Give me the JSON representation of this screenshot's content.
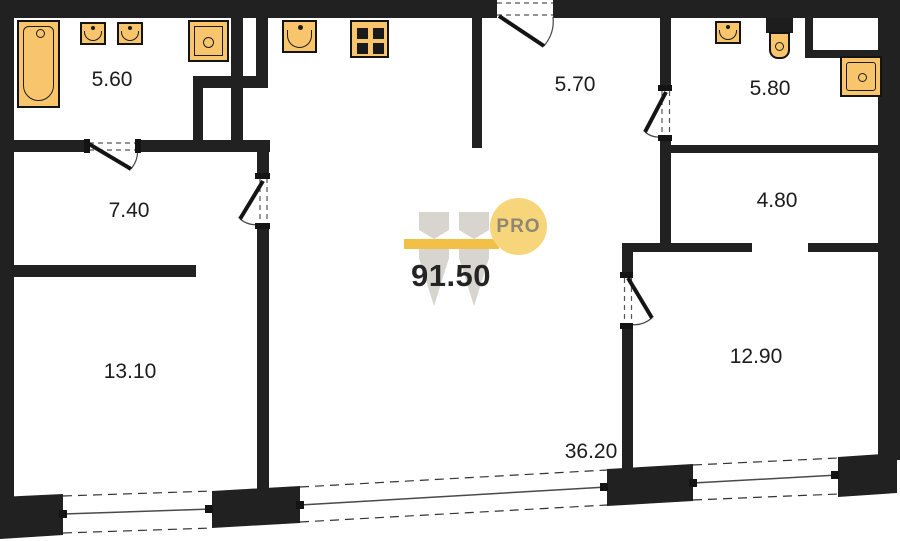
{
  "floorplan": {
    "total_area": "91.50",
    "logo": {
      "brand": "PRO"
    },
    "rooms": [
      {
        "name": "bathroom-top-left",
        "area": "5.60"
      },
      {
        "name": "corridor-left",
        "area": "7.40"
      },
      {
        "name": "bedroom-left",
        "area": "13.10"
      },
      {
        "name": "entrance-hall",
        "area": "5.70"
      },
      {
        "name": "bathroom-top-right",
        "area": "5.80"
      },
      {
        "name": "storage",
        "area": "4.80"
      },
      {
        "name": "bedroom-right",
        "area": "12.90"
      },
      {
        "name": "living-kitchen",
        "area": "36.20"
      }
    ],
    "fixtures": [
      "bathtub-icon",
      "sink-icon",
      "sink-icon",
      "washing-machine-icon",
      "kitchen-sink-icon",
      "stove-icon",
      "sink-icon",
      "toilet-icon",
      "shower-icon"
    ],
    "colors": {
      "wall": "#212121",
      "fixture_fill": "#f8c56c",
      "accent_gold": "#f2bf47",
      "logo_circle_fill": "#f7d57a",
      "logo_text": "#8e8775",
      "watermark_gray": "#d8d4d0",
      "window_line": "#4a4a4a",
      "label": "#1c1c1c",
      "background": "#ffffff"
    }
  }
}
